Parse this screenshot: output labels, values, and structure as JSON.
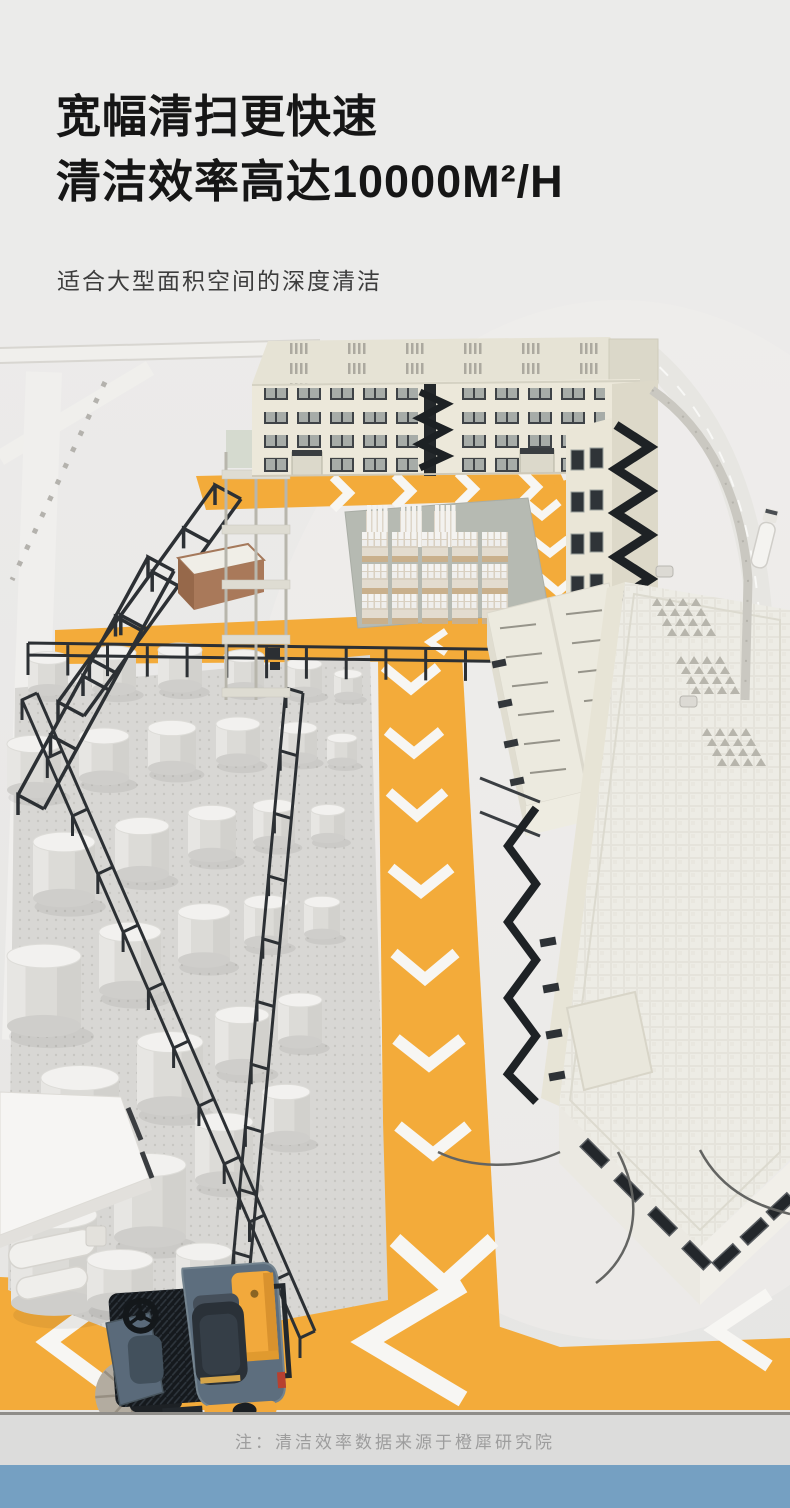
{
  "header": {
    "title_line1": "宽幅清扫更快速",
    "title_line2": "清洁效率高达10000M²/H",
    "subtitle": "适合大型面积空间的深度清洁"
  },
  "scene": {
    "route_yellow": "#f3ab3a",
    "arrow_white": "#f7f6f3",
    "vehicle_body_gray": "#5d6e7e",
    "vehicle_accent_yellow": "#f2a93c"
  },
  "footer": {
    "note": "注：清洁效率数据来源于橙犀研究院",
    "bar_blue": "#75a0c2"
  }
}
